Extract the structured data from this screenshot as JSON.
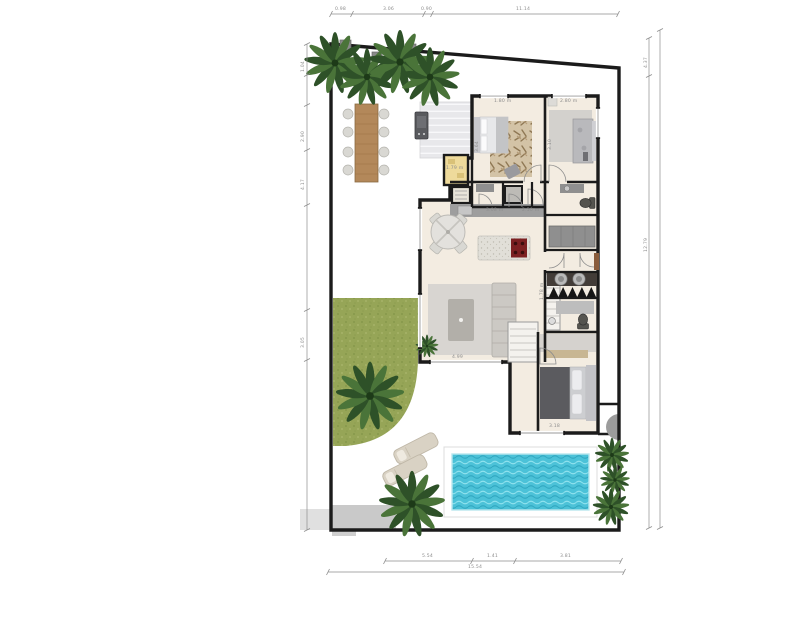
{
  "title": "house-floor-plan-with-pool",
  "colors": {
    "wall": "#1b1b1b",
    "floor": "#f3ece1",
    "grass": "#96a557",
    "pool_water": "#4cc2d8",
    "drive": "#c9c9c9",
    "wood": "#b3885a",
    "cooktop": "#7c2022",
    "yellow_room": "#eeda9b",
    "door_wood": "#8a5c3b",
    "tree_dark": "#2e5128",
    "tree_mid": "#4a7439",
    "dim": "#8d8d8d",
    "deck": "#e8e8eb",
    "sofa": "#ccc9c4",
    "rug": "#d8d5d1",
    "duvet": "#5b5b5f"
  },
  "dims": {
    "top": [
      "0.98",
      "3.06",
      "0.90",
      "11.14"
    ],
    "left": [
      "1.04",
      "2.90",
      "4.17",
      "3.05"
    ],
    "right": [
      "4.37",
      "12.79"
    ],
    "bottom_inner": [
      "5.54",
      "1.41",
      "3.81"
    ],
    "bottom_outer": [
      "15.54"
    ],
    "room": [
      "1.80 m",
      "2.80 m",
      "3.64",
      "3.10",
      "1.79 m",
      "3.08 m",
      "2.50 m",
      "1.78 m",
      "4.99",
      "3.18"
    ]
  }
}
